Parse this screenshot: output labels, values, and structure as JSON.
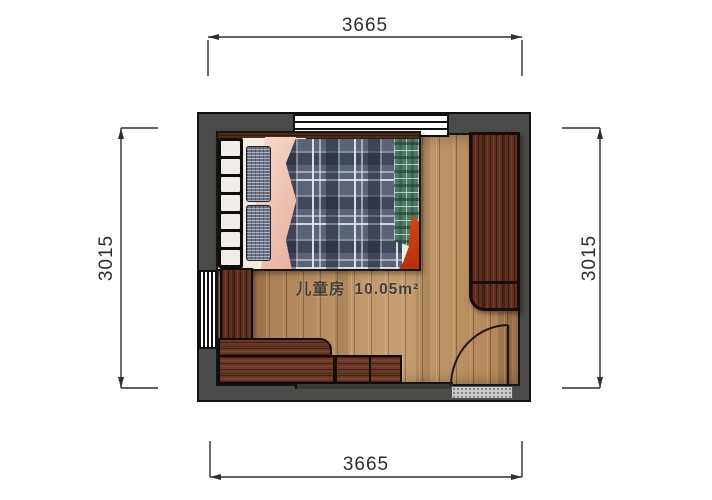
{
  "room": {
    "name": "儿童房",
    "area": "10.05m²"
  },
  "dimensions": {
    "top": {
      "value": "3665"
    },
    "bottom": {
      "value": "3665"
    },
    "left": {
      "value": "3015"
    },
    "right": {
      "value": "3015"
    }
  },
  "theme": {
    "background": "#ffffff",
    "wall": "#4b4b49",
    "outline": "#161616",
    "dimension": "#2e2e2e",
    "floor": "#b78a5d",
    "furniture_wood": "#5e2f21",
    "desk_wood": "#6c3826",
    "duvet": "#5a6377",
    "sheet": "#f3ecdf",
    "pink_blanket": "#f2cabe",
    "green_blanket": "#4f7a60",
    "red_accent": "#cf3c12",
    "threshold": "#cbcbcb",
    "window": "#ffffff",
    "label_text": "#433d37"
  }
}
